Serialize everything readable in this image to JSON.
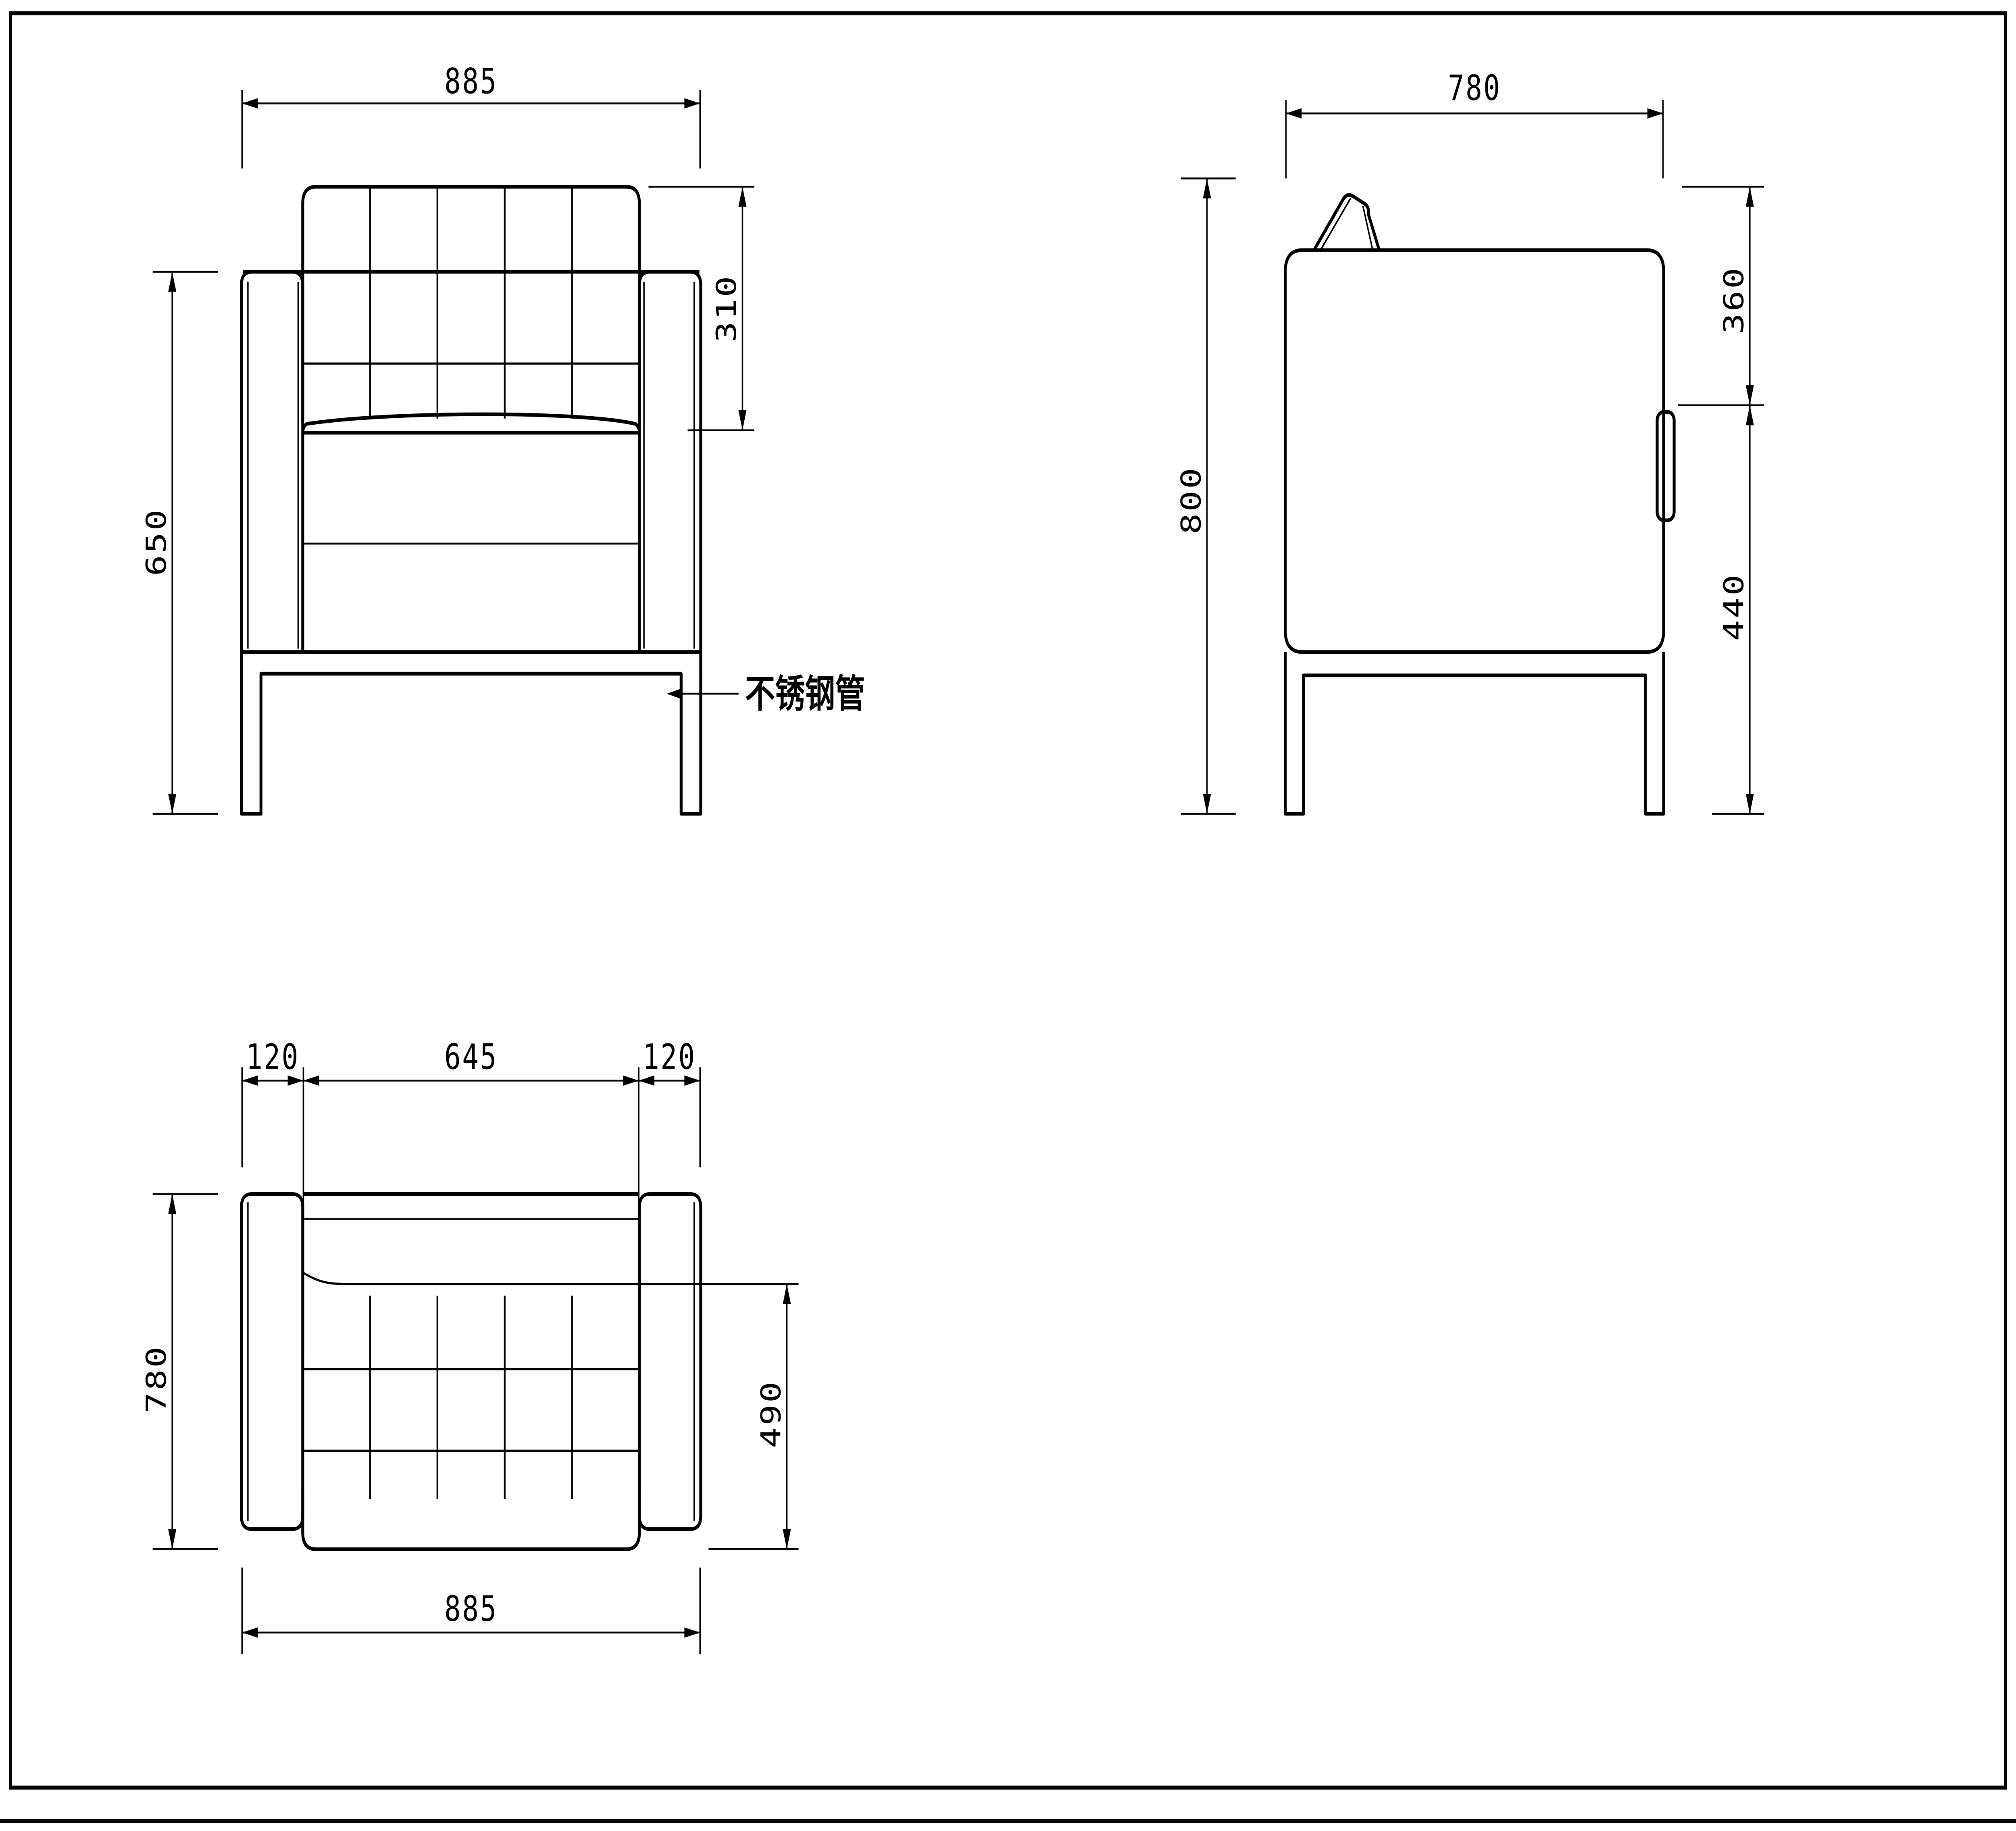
{
  "drawing": {
    "background": "#ffffff",
    "line_color": "#000000",
    "front_view": {
      "width": "885",
      "backrest_height": "310",
      "arm_floor_height": "650",
      "leg_label": "不锈钢管"
    },
    "side_view": {
      "depth": "780",
      "total_height": "800",
      "back_upper": "360",
      "seat_height": "440"
    },
    "top_view": {
      "arm_left": "120",
      "seat_width": "645",
      "arm_right": "120",
      "depth": "780",
      "seat_depth": "490",
      "overall_width": "885"
    }
  }
}
